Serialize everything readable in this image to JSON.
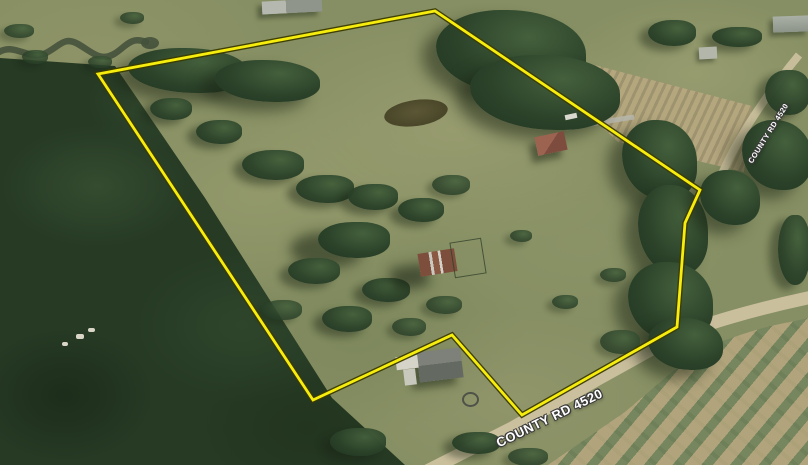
{
  "labels": {
    "road_bottom": "COUNTY RD 4520",
    "road_right": "COUNTY RD 4520"
  },
  "boundary": {
    "color": "#f6ec0e",
    "outline_color": "#3a3a00",
    "points": [
      [
        98,
        74
      ],
      [
        435,
        11
      ],
      [
        700,
        190
      ],
      [
        685,
        223
      ],
      [
        677,
        327
      ],
      [
        522,
        415
      ],
      [
        452,
        335
      ],
      [
        313,
        400
      ]
    ]
  },
  "terrain_colors": {
    "grass_field": "#868f63",
    "forest": "#263a24",
    "plowed_field": "#ae9f78",
    "road": "#cdc2a0"
  }
}
